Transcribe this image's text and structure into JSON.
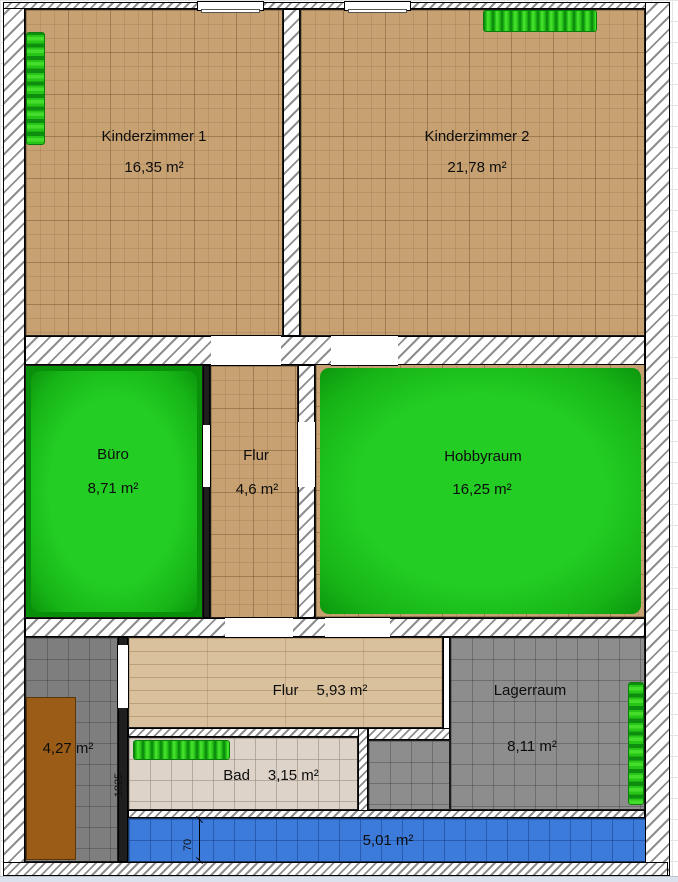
{
  "rooms": {
    "kz1": {
      "name": "Kinderzimmer 1",
      "area": "16,35 m²"
    },
    "kz2": {
      "name": "Kinderzimmer 2",
      "area": "21,78 m²"
    },
    "buero": {
      "name": "Büro",
      "area": "8,71 m²"
    },
    "flur_mid": {
      "name": "Flur",
      "area": "4,6 m²"
    },
    "hobbyraum": {
      "name": "Hobbyraum",
      "area": "16,25 m²"
    },
    "flur_low": {
      "name": "Flur",
      "area": "5,93 m²"
    },
    "lagerraum": {
      "name": "Lagerraum",
      "area": "8,11 m²"
    },
    "abstellraum": {
      "area": "4,27 m²"
    },
    "bad": {
      "name": "Bad",
      "area": "3,15 m²"
    },
    "balkon": {
      "area": "5,01 m²"
    }
  },
  "dimensions": {
    "balkon_height": "70",
    "bad_left_wall": "1825"
  },
  "colors": {
    "cork_floor": "#c7a172",
    "wood_floor": "#d9c19d",
    "green_carpet": "#23cd23",
    "green_carpet_edge": "#0c960c",
    "gray_tile": "#8d8d8d",
    "bath_tile": "#ddd3c8",
    "blue_tile": "#3c7bd9",
    "radiator_green": "#27c517",
    "furniture_brown": "#9a5c17"
  }
}
